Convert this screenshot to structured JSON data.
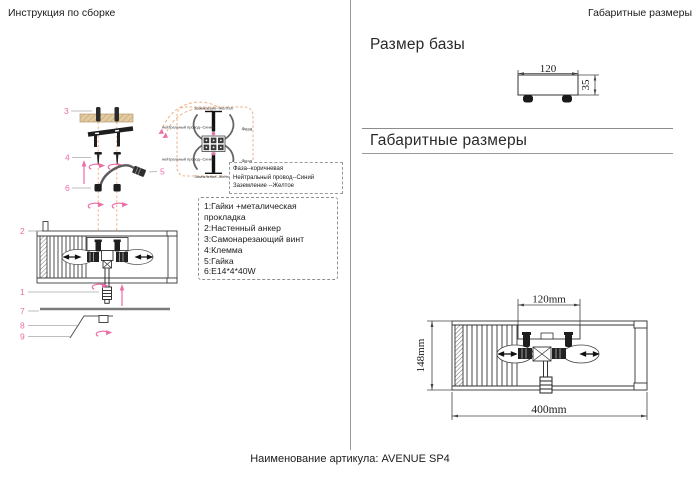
{
  "header": {
    "left_title": "Инструкция по сборке",
    "right_title": "Габаритные размеры"
  },
  "footer": {
    "article_line": "Наименование артикула: AVENUE SP4"
  },
  "sections": {
    "base_title": "Размер базы",
    "overall_title": "Габаритные размеры"
  },
  "base_drawing": {
    "width_label": "120",
    "height_label": "35"
  },
  "overall_drawing": {
    "bracket_width_label": "120mm",
    "height_label": "148mm",
    "width_label": "400mm"
  },
  "assembly": {
    "callouts": {
      "c1": "1",
      "c2": "2",
      "c3": "3",
      "c4": "4",
      "c5": "5",
      "c6": "6",
      "c7": "7",
      "c8": "8",
      "c9": "9"
    },
    "wiring": {
      "ground_label": "Заземление--Желтая",
      "neutral_label": "нейтральный провод--Синий",
      "phase_label": "Фаза"
    },
    "wire_colors": {
      "line1": "Фаза--коричневая",
      "line2": "Нейтральный провод--Синий",
      "line3": "Заземление --Желтое"
    },
    "parts": [
      "1:Гайки +металическая прокладка",
      "2:Настенный анкер",
      "3:Самонарезающий винт",
      "4:Клемма",
      "5:Гайка",
      "6:E14*4*40W"
    ]
  },
  "colors": {
    "accent_pink": "#ec6ca8",
    "dash_orange": "#f2b183",
    "board_tan": "#e3caa1"
  }
}
